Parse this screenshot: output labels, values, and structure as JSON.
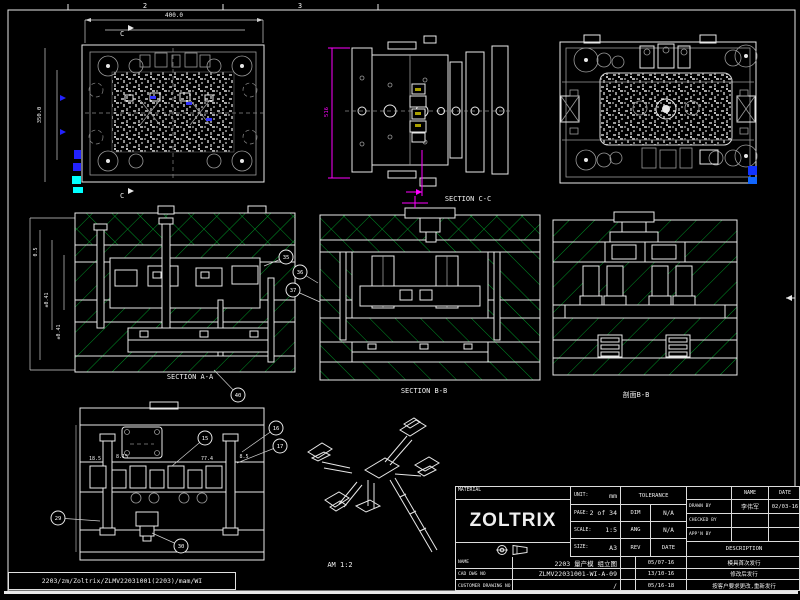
{
  "colors": {
    "background": "#000000",
    "line": "#e8e8e8",
    "detail_gray": "#9a9a9a",
    "hatch_green": "#00a32a",
    "dim_magenta": "#ff00ff",
    "accent_blue": "#2222ff",
    "accent_cyan": "#00ffff"
  },
  "frame": {
    "zone_labels": [
      "2",
      "3"
    ],
    "path_label": "2203/zm/Zoltrix/ZLMV22031001(2203)/mam/WI"
  },
  "views": {
    "plan_top": {
      "dim_top": "400.0",
      "dim_left": "350.0",
      "section_marker": "C"
    },
    "section_cc": {
      "label": "SECTION C-C",
      "dim_left": "516"
    },
    "section_aa": {
      "label": "SECTION A-A",
      "dims": [
        "0.5",
        "±0.41",
        "±0.41"
      ]
    },
    "section_bb": {
      "label": "SECTION B-B"
    },
    "section_right": {
      "label": "剖面B-B"
    },
    "ejector": {
      "dims": [
        "18.5",
        "8.15",
        "77.4",
        "8.5"
      ]
    },
    "iso": {
      "label": "AM 1:2"
    }
  },
  "balloons": [
    {
      "x": 286,
      "y": 257,
      "n": "35",
      "lx": 264,
      "ly": 266
    },
    {
      "x": 300,
      "y": 272,
      "n": "36",
      "lx": 318,
      "ly": 283
    },
    {
      "x": 293,
      "y": 290,
      "n": "37",
      "lx": 320,
      "ly": 302
    },
    {
      "x": 238,
      "y": 395,
      "n": "40",
      "lx": 214,
      "ly": 370
    },
    {
      "x": 276,
      "y": 428,
      "n": "16",
      "lx": 242,
      "ly": 452
    },
    {
      "x": 280,
      "y": 446,
      "n": "17",
      "lx": 237,
      "ly": 463
    },
    {
      "x": 205,
      "y": 438,
      "n": "15",
      "lx": 172,
      "ly": 466
    },
    {
      "x": 58,
      "y": 518,
      "n": "29",
      "lx": 100,
      "ly": 521
    },
    {
      "x": 181,
      "y": 546,
      "n": "30",
      "lx": 152,
      "ly": 533
    }
  ],
  "title_block": {
    "material_label": "MATERIAL",
    "logo": "ZOLTRIX",
    "unit_label": "UNIT:",
    "unit_value": "mm",
    "page_label": "PAGE:",
    "page_value": "2 of 34",
    "scale_label": "SCALE:",
    "scale_value": "1:5",
    "size_label": "SIZE:",
    "size_value": "A3",
    "tolerance_label": "TOLERANCE",
    "dim_label": "DIM",
    "dim_value": "N/A",
    "ang_label": "ANG",
    "ang_value": "N/A",
    "rev_label": "REV",
    "rev_date_label": "DATE",
    "name_col_label": "NAME",
    "date_col_label": "DATE",
    "drawn_by_label": "DRAWN BY",
    "drawn_by_name": "李伟军",
    "drawn_by_date": "02/03-16",
    "checked_by_label": "CHECKED BY",
    "appn_by_label": "APP'N BY",
    "description_label": "DESCRIPTION",
    "rows": [
      {
        "label": "NAME",
        "value": "2203 量产模 组立图",
        "date": "05/07-16",
        "desc": "模具首次发行"
      },
      {
        "label": "CAD DWG NO",
        "value": "ZLMV22031001-WI-A-09",
        "date": "13/10-16",
        "desc": "修改后发行"
      },
      {
        "label": "CUSTOMER DRAWING NO",
        "value": "/",
        "date": "05/16-18",
        "desc": "按客户要求更改,重新发行"
      }
    ]
  }
}
